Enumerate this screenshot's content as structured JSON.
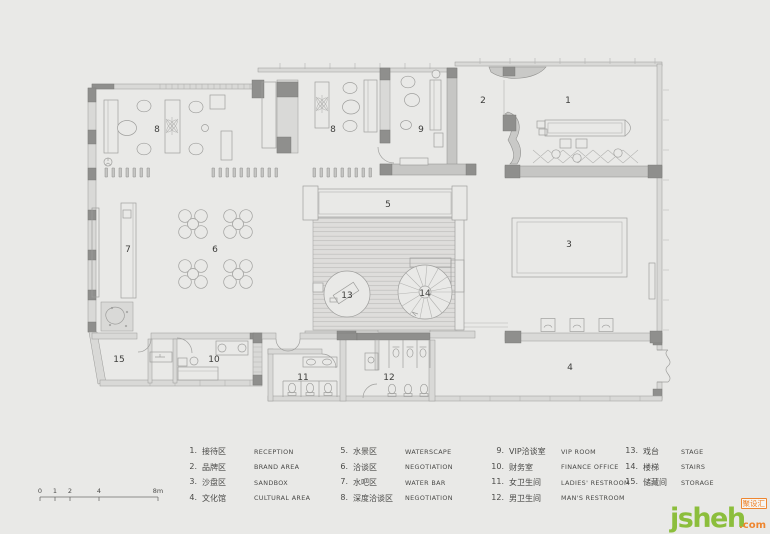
{
  "plan": {
    "rooms": {
      "r1": "1",
      "r2": "2",
      "r3": "3",
      "r4": "4",
      "r5": "5",
      "r6": "6",
      "r7": "7",
      "r8": "8",
      "r9": "9",
      "r10": "10",
      "r11": "11",
      "r12": "12",
      "r13": "13",
      "r14": "14",
      "r15": "15"
    }
  },
  "scalebar": {
    "labels": [
      "0",
      "1",
      "2",
      "4",
      "8m"
    ]
  },
  "legend": {
    "columns": [
      {
        "items": [
          {
            "num": "1.",
            "zh": "接待区",
            "en": "RECEPTION"
          },
          {
            "num": "2.",
            "zh": "品牌区",
            "en": "BRAND AREA"
          },
          {
            "num": "3.",
            "zh": "沙盘区",
            "en": "SANDBOX"
          },
          {
            "num": "4.",
            "zh": "文化馆",
            "en": "CULTURAL AREA"
          }
        ]
      },
      {
        "items": [
          {
            "num": "5.",
            "zh": "水景区",
            "en": "WATERSCAPE"
          },
          {
            "num": "6.",
            "zh": "洽谈区",
            "en": "NEGOTIATION"
          },
          {
            "num": "7.",
            "zh": "水吧区",
            "en": "WATER BAR"
          },
          {
            "num": "8.",
            "zh": "深度洽谈区",
            "en": "NEGOTIATION"
          }
        ]
      },
      {
        "items": [
          {
            "num": "9.",
            "zh": "VIP洽谈室",
            "en": "VIP ROOM"
          },
          {
            "num": "10.",
            "zh": "财务室",
            "en": "FINANCE OFFICE"
          },
          {
            "num": "11.",
            "zh": "女卫生间",
            "en": "LADIES' RESTROOM"
          },
          {
            "num": "12.",
            "zh": "男卫生间",
            "en": "MAN'S RESTROOM"
          }
        ]
      },
      {
        "items": [
          {
            "num": "13.",
            "zh": "戏台",
            "en": "STAGE"
          },
          {
            "num": "14.",
            "zh": "楼梯",
            "en": "STAIRS"
          },
          {
            "num": "15.",
            "zh": "储藏间",
            "en": "STORAGE"
          }
        ]
      }
    ]
  },
  "watermark": {
    "name": "jsheh",
    "tld": ".com",
    "badge": "聚设汇"
  },
  "colors": {
    "background": "#e9e9e7",
    "wall": "#8e8e8c",
    "logo_green": "#8cbe3c",
    "logo_orange": "#ee8630"
  }
}
